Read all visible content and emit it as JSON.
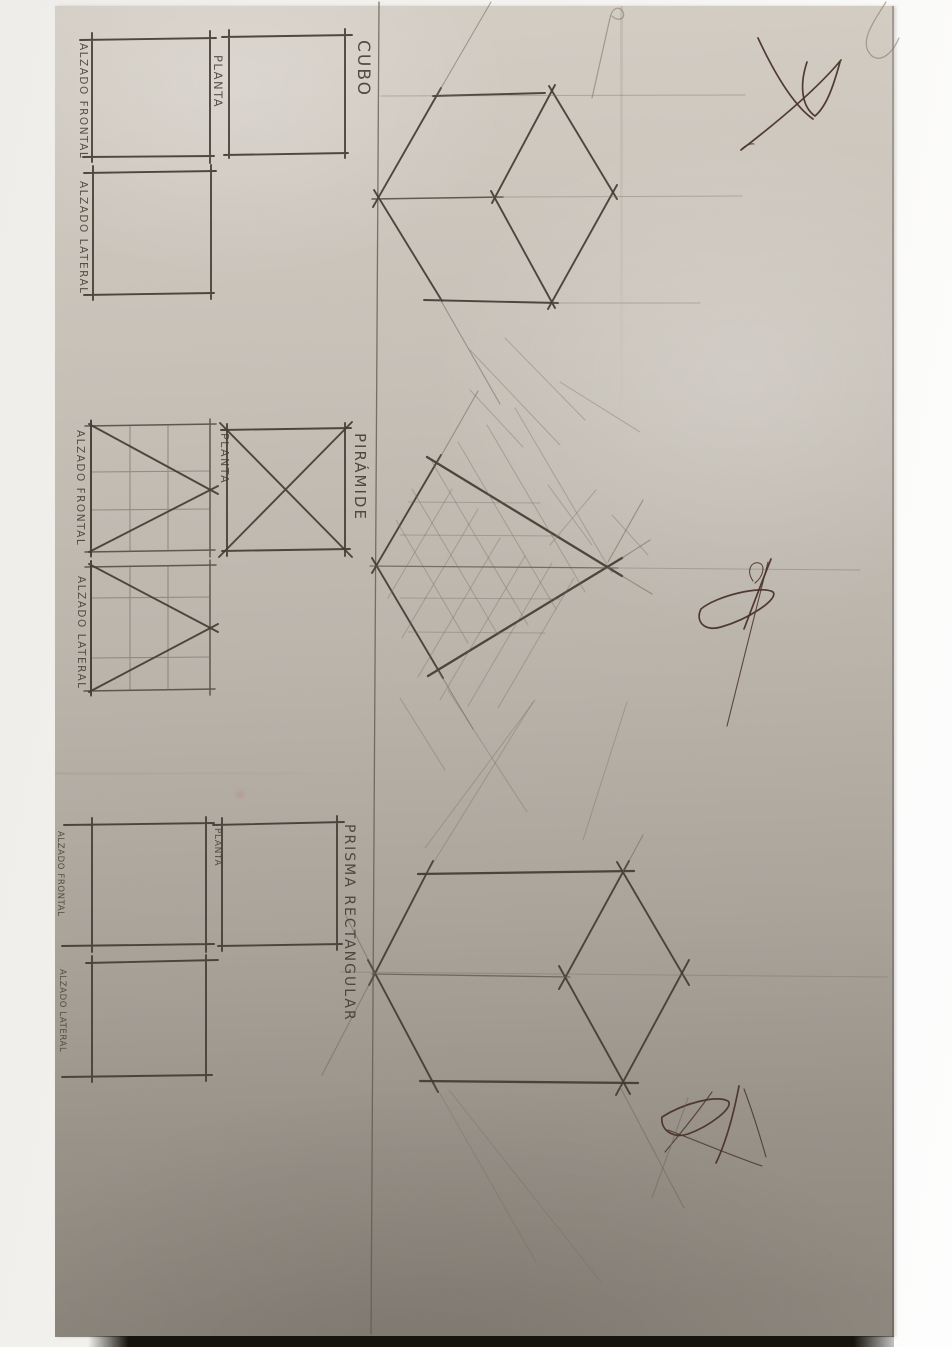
{
  "photo": {
    "description": "Photograph of a pencil technical-drawing worksheet, rotated 90 degrees clockwise",
    "content": "Dihedral-system views (planta, alzado frontal, alzado lateral) and isometric perspective drawings of three solids"
  },
  "sections": {
    "cubo": {
      "title": "CUBO",
      "frontal": "ALZADO FRONTAL",
      "planta": "PLANTA",
      "lateral": "ALZADO LATERAL"
    },
    "piramide": {
      "title": "PIRÁMIDE",
      "frontal": "ALZADO FRONTAL",
      "planta": "PLANTA",
      "lateral": "ALZADO LATERAL"
    },
    "prisma": {
      "title": "PRISMA RECTANGULAR",
      "frontal": "ALZADO FRONTAL",
      "planta": "PLANTA",
      "lateral": "ALZADO LATERAL"
    }
  },
  "colors": {
    "paper_top": "#d3cdc4",
    "paper_bottom": "#8e887f",
    "pencil_dark": "#433c33",
    "pencil_faint": "#756d60",
    "ink_signature": "#4a332a",
    "margin_white": "#fbfbfa",
    "photo_edge": "#17130e"
  }
}
